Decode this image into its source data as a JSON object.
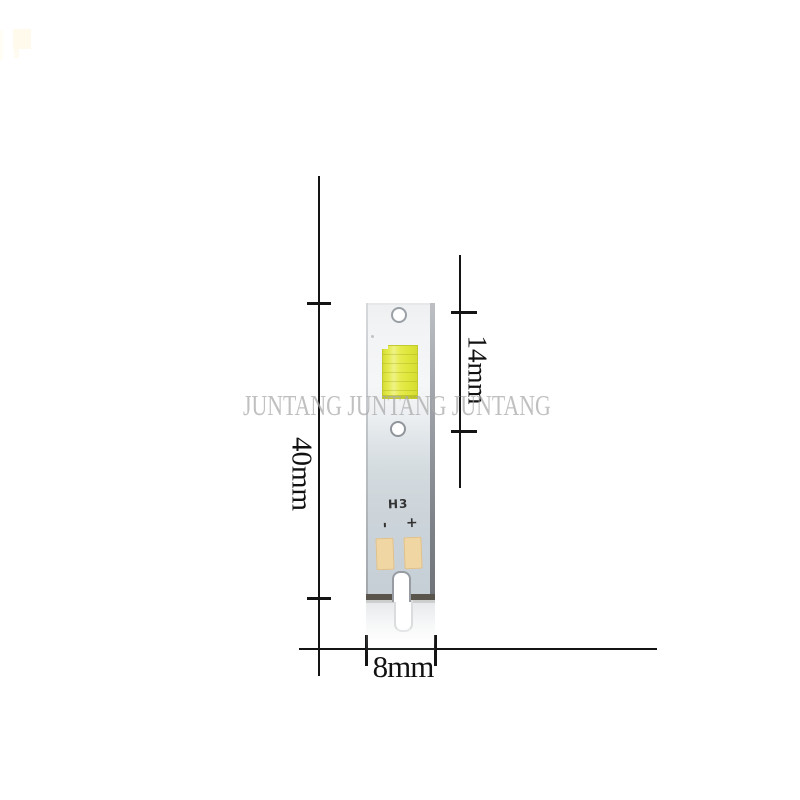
{
  "watermark": {
    "text": "JUNTANG JUNTANG JUNTANG"
  },
  "module": {
    "model_label": "H3",
    "polarity_negative": "-",
    "polarity_positive": "+"
  },
  "dimensions": {
    "height_label": "40mm",
    "led_section_label": "14mm",
    "width_label": "8mm"
  },
  "colors": {
    "background": "#ffffff",
    "dimension_line": "#141414",
    "pcb_top": "#f5f6f7",
    "pcb_bottom": "#c5ced5",
    "pcb_bottom_edge": "#59554d",
    "led_phosphor_yellow": "#dfe63c",
    "solder_pad_tan": "#f0d6a2",
    "watermark_gray": "#a8a8a8",
    "corner_mark_cream": "#fffaec"
  }
}
